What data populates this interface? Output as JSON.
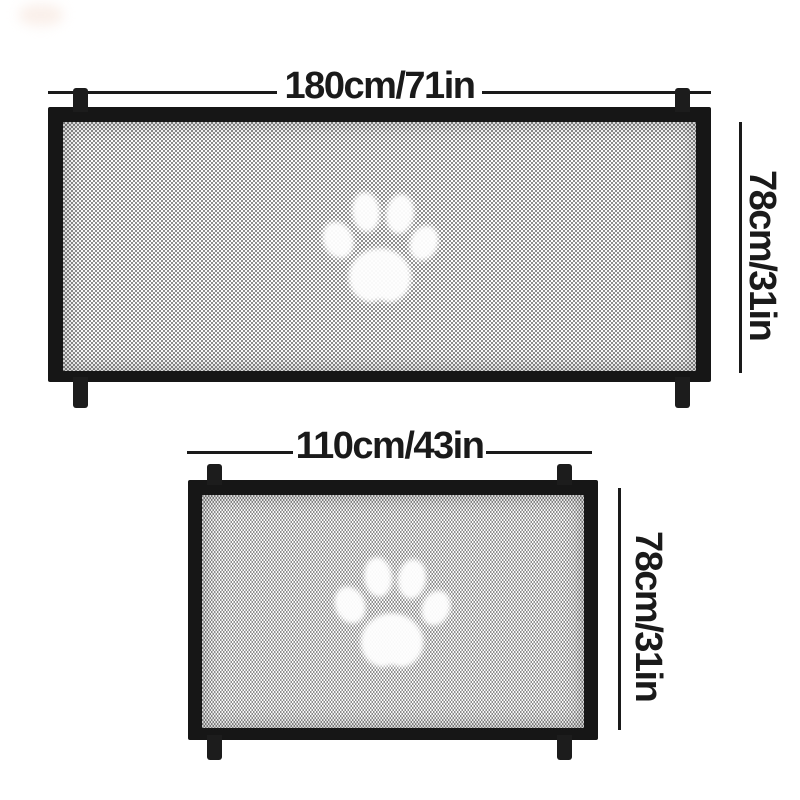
{
  "canvas": {
    "width": 800,
    "height": 800
  },
  "colors": {
    "background": "#ffffff",
    "frame": "#161616",
    "strap": "#1c1c1c",
    "mesh_light": "#fbfbfb",
    "mesh_dark": "#8d8d8d",
    "dimension": "#1a1a1a",
    "paw": "#ffffff"
  },
  "gates": [
    {
      "id": "large-mesh-pet-gate",
      "width_label": "180cm/71in",
      "height_label": "78cm/31in",
      "icon": "paw-print-icon",
      "straps": 4
    },
    {
      "id": "small-mesh-pet-gate",
      "width_label": "110cm/43in",
      "height_label": "78cm/31in",
      "icon": "paw-print-icon",
      "straps": 4
    }
  ]
}
